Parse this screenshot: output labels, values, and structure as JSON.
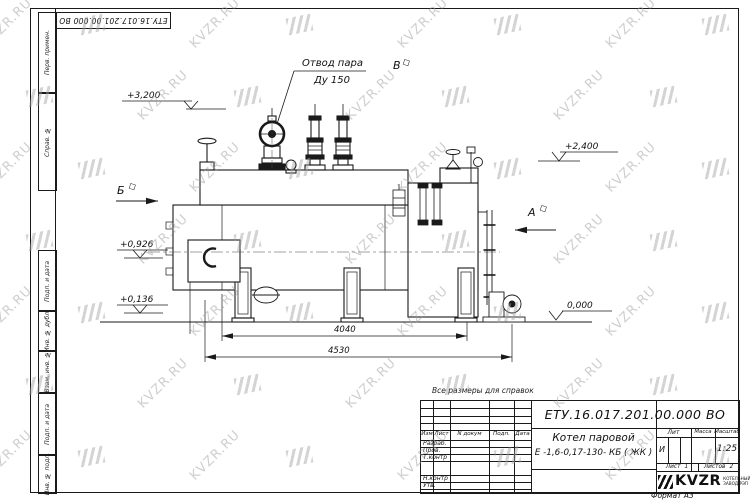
{
  "watermark": {
    "text": "KVZR.RU",
    "color": "#9f9f9f",
    "rows": 7,
    "cols": 8,
    "x0": -25,
    "y0": 16,
    "dx": 104,
    "dy": 72,
    "stagger": 52
  },
  "frame": {
    "top_stamp": "ЕТУ.16.017.201.00.000  ВО",
    "left_cells": [
      "Перв. примен.",
      "Справ. №",
      "Подп. и дата",
      "Инв. № дубл.",
      "Взам. инв. №",
      "Подп. и дата",
      "Инв. № подл."
    ]
  },
  "drawing": {
    "note": "Все размеры для справок",
    "labels": {
      "steam_line1": "Отвод пара",
      "steam_line2": "Ду 150",
      "view_b": "Б",
      "view_a": "А",
      "view_v": "В",
      "elev1": "+3,200",
      "elev2": "+2,400",
      "elev3": "+0,926",
      "elev4": "+0,136",
      "elev5": "0,000",
      "dim1": "4040",
      "dim2": "4530"
    }
  },
  "title_block": {
    "designation": "ЕТУ.16.017.201.00.000  ВО",
    "product_name_line1": "Котел паровой",
    "product_name_line2": "Е -1,6-0,17-130- КБ ( ЖК )",
    "change_header": [
      "Изм",
      "Лист",
      "N докум",
      "Подп.",
      "Дата"
    ],
    "signature_rows": [
      "Разраб.",
      "Пров.",
      "Т.контр",
      "Н.контр",
      "Утв."
    ],
    "lit_label": "Лит",
    "mass_label": "Масса",
    "scale_label": "Масштаб",
    "lit_value": "И",
    "scale_value": "1:25",
    "sheet_label": "Лист",
    "sheet_value": "1",
    "sheets_label": "Листов",
    "sheets_value": "2",
    "logo_text": "KVZR",
    "logo_sub_line1": "КОТЕЛЬНЫЙ",
    "logo_sub_line2": "ЗАВОД РЭП",
    "format_label": "Формат А3"
  }
}
